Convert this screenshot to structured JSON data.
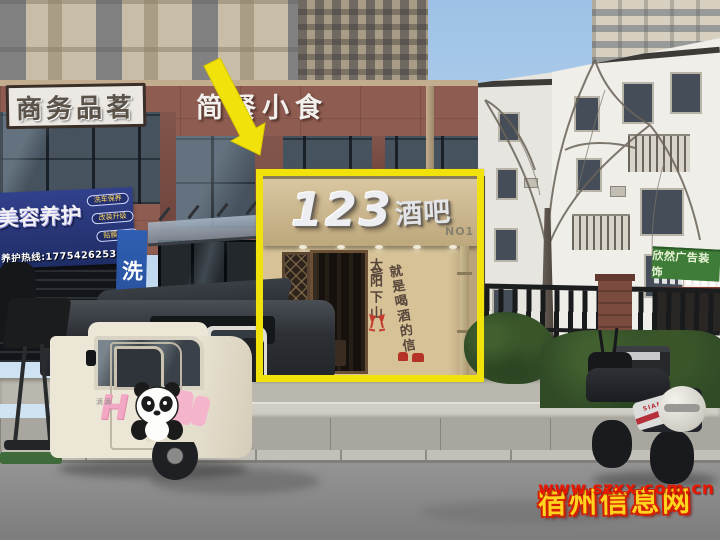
{
  "annotations": {
    "highlight_color": "#f0e20a",
    "watermark": {
      "site_name": "宿州信息网",
      "site_url": "www.szxx.com.cn"
    }
  },
  "bar_storefront": {
    "sign_number": "123",
    "sign_word": "酒吧",
    "sign_no": "NO1",
    "slogan_col1": "太阳下山",
    "slogan_col2": "就是喝酒的信号"
  },
  "left_building": {
    "tea_sign": "商务品茗",
    "snack_sign": "简餐小食",
    "beauty_sign_title": "美容养护",
    "beauty_services": [
      "洗车保养",
      "改装升级",
      "贴膜改色"
    ],
    "beauty_hotline": "养护热线:17754262535",
    "carwash_sign": "洗车"
  },
  "right_buildings": {
    "ad_sign": "欣然广告装饰"
  },
  "vehicles": {
    "trike_marking": "滴滴",
    "trike_decal_letter": "H",
    "scooter_panel_text": "SIAMA"
  }
}
